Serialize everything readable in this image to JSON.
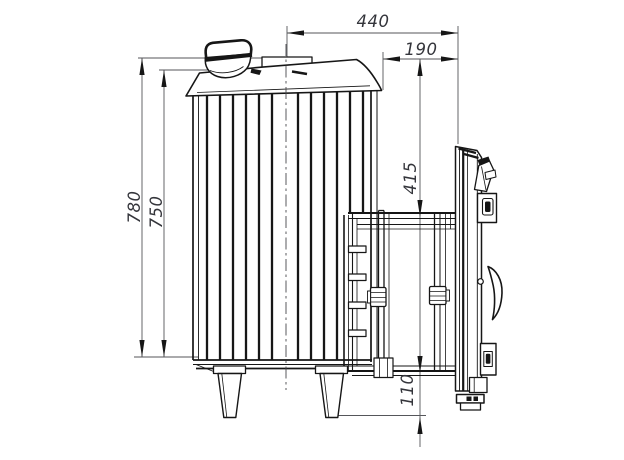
{
  "dimensions": {
    "top_width": "440",
    "tunnel_width": "190",
    "height_overall": "780",
    "height_body": "750",
    "portal_height": "415",
    "bottom_clearance": "110"
  },
  "colors": {
    "background": "#ffffff",
    "line": "#161616",
    "thin_line": "#55565a",
    "dim_text": "#34353b"
  }
}
